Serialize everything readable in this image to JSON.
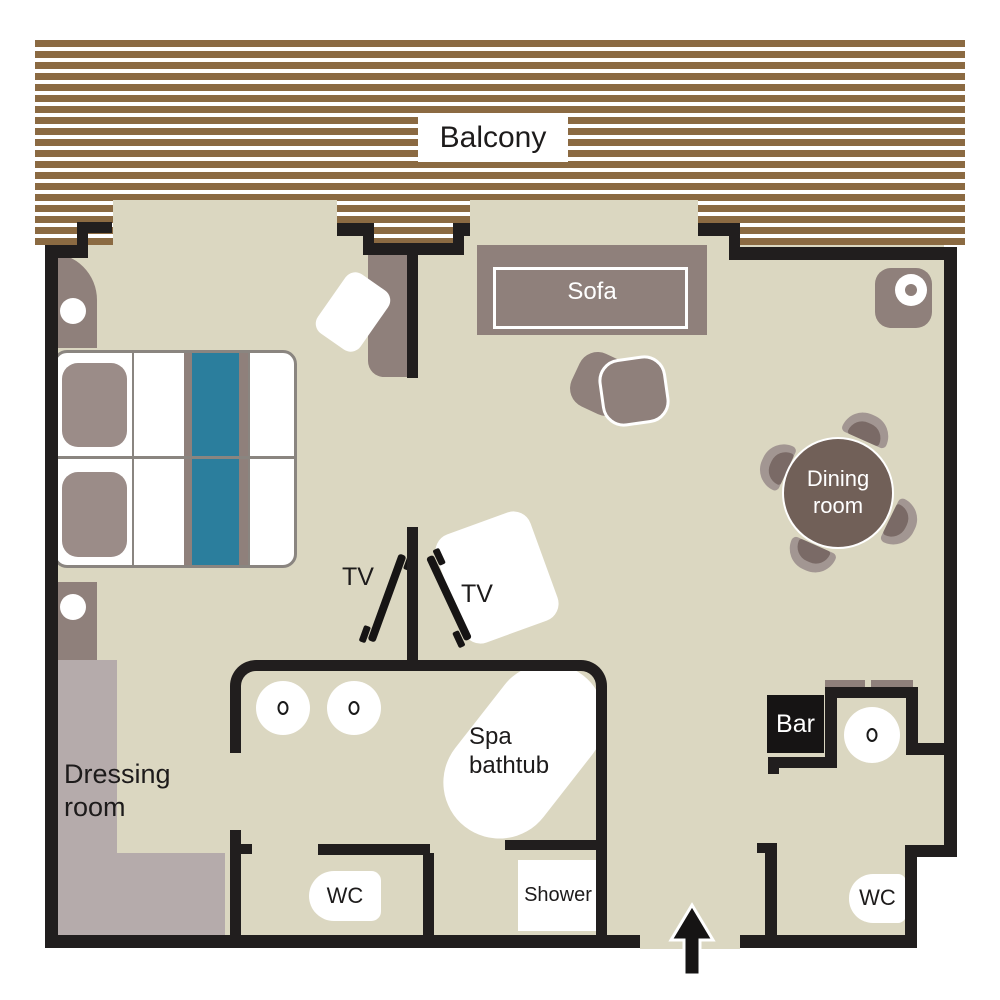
{
  "type": "hotel-suite-floor-plan",
  "areas": {
    "balcony": {
      "label": "Balcony"
    },
    "living_room": {
      "sofa": "Sofa",
      "dining": "Dining room",
      "bar": "Bar"
    },
    "bedroom": {
      "tv_left": "TV",
      "tv_right": "TV",
      "dressing": "Dressing room"
    },
    "bathroom": {
      "spa": "Spa bathtub",
      "wc": "WC",
      "shower": "Shower"
    },
    "guest_wc": {
      "wc": "WC"
    }
  },
  "colors": {
    "wall": "#211e1e",
    "floor": "#dbd7c1",
    "deck": "#8b6a42",
    "taupe": "#8f807b",
    "pillow": "#9b8c88",
    "teal": "#2b7e9d",
    "mauve": "#b5abab",
    "table_dark": "#716058",
    "chair_light": "#a29692",
    "chair_dark": "#7a6a66"
  }
}
